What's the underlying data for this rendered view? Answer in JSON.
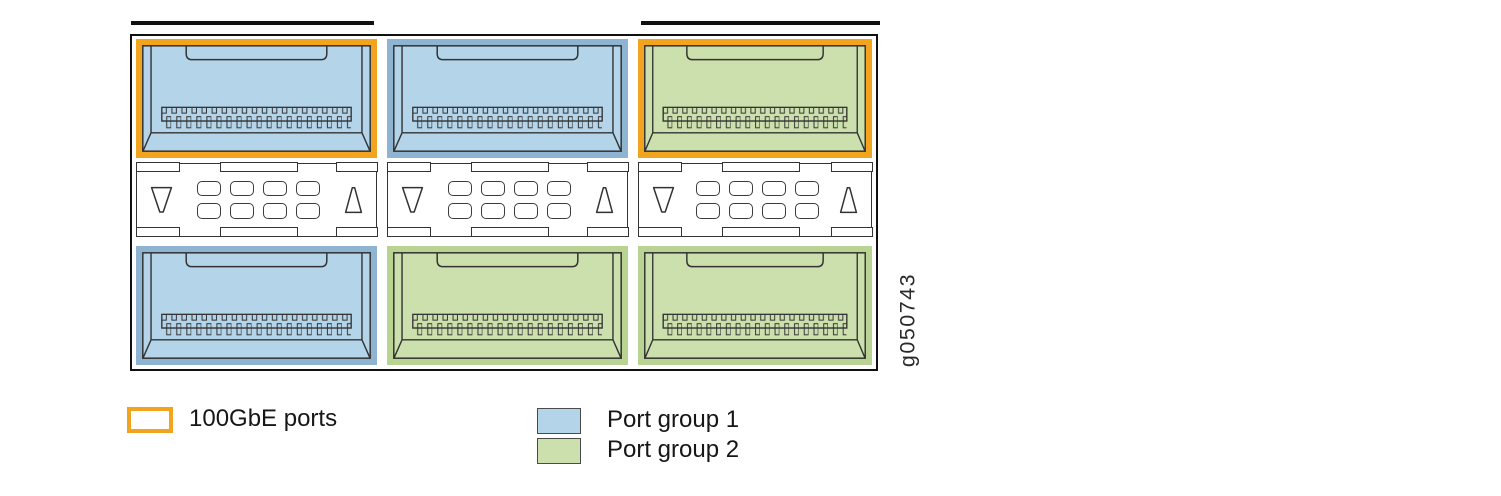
{
  "figure": {
    "type": "switch-port-group-diagram",
    "id_label": "g050743",
    "modules": [
      {
        "row": "top",
        "position": "left",
        "group": "Port group 1",
        "is_100gbe": true
      },
      {
        "row": "top",
        "position": "center",
        "group": "Port group 1",
        "is_100gbe": false
      },
      {
        "row": "top",
        "position": "right",
        "group": "Port group 2",
        "is_100gbe": true
      },
      {
        "row": "bottom",
        "position": "left",
        "group": "Port group 1",
        "is_100gbe": false
      },
      {
        "row": "bottom",
        "position": "center",
        "group": "Port group 2",
        "is_100gbe": false
      },
      {
        "row": "bottom",
        "position": "right",
        "group": "Port group 2",
        "is_100gbe": false
      }
    ],
    "status_panel": {
      "led_slots_per_module": 8,
      "arrow_icons": [
        "down",
        "up"
      ]
    }
  },
  "colors": {
    "highlight_100gbe": "#F2A41F",
    "group1_fill": "#B4D4E9",
    "group1_ring": "#8FB4D1",
    "group2_fill": "#CCE0AD",
    "group2_ring": "#B9D393",
    "outline": "#333333"
  },
  "legend": {
    "items": [
      {
        "key": "100gbe",
        "label": "100GbE ports",
        "swatch_color": "#F2A41F",
        "swatch_style": "outline"
      },
      {
        "key": "group1",
        "label": "Port group 1",
        "swatch_color": "#B4D4E9",
        "swatch_style": "fill"
      },
      {
        "key": "group2",
        "label": "Port group 2",
        "swatch_color": "#CCE0AD",
        "swatch_style": "fill"
      }
    ]
  }
}
